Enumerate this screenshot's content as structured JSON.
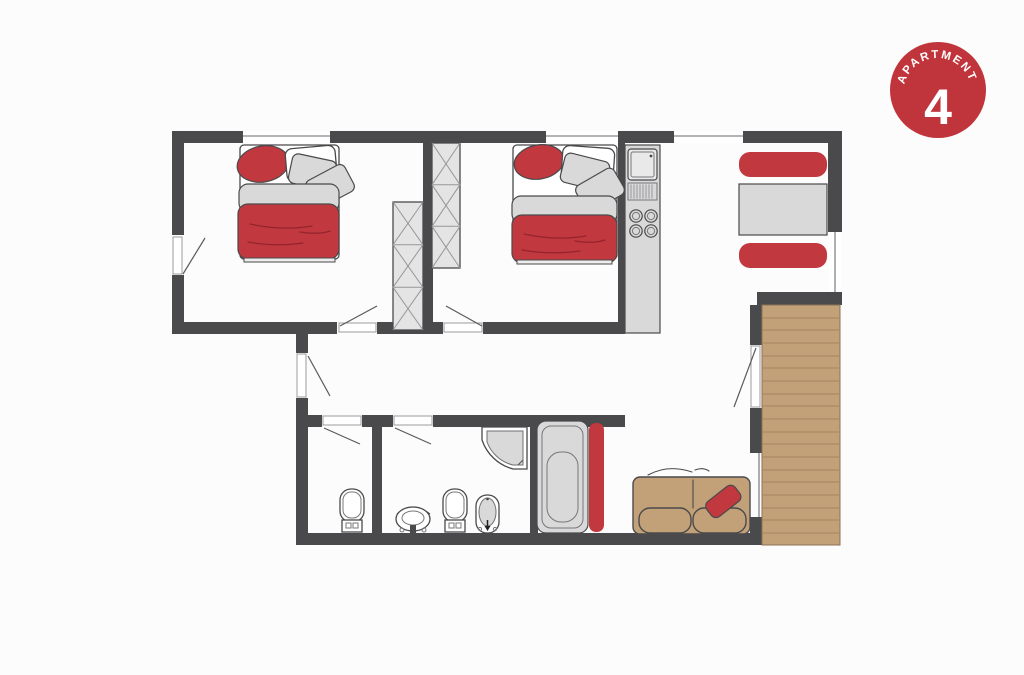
{
  "badge": {
    "label": "APARTMENT",
    "number": "4",
    "bg_color": "#c0353c",
    "text_color": "#ffffff"
  },
  "palette": {
    "wall": "#4a4a4c",
    "accent_red": "#c2383f",
    "furniture_gray": "#d9d9d9",
    "furniture_outline": "#4a4a4c",
    "stairs_wood": "#c2a078",
    "stairs_step_line": "#a5855f",
    "sofa_tan": "#c2a37d",
    "wardrobe_fill": "#e4e4e4",
    "window_line": "#9b9b9e",
    "background": "#fcfcfc"
  },
  "plan_icons": [
    "double-bed-icon",
    "double-bed-icon",
    "wardrobe-crosshatch-icon",
    "wardrobe-crosshatch-icon",
    "kitchen-sink-icon",
    "kitchen-hob-icon",
    "dining-table-icon",
    "bench-seat-icon",
    "bench-seat-icon",
    "staircase-icon",
    "corner-shower-icon",
    "bathtub-icon",
    "toilet-icon",
    "toilet-icon",
    "wash-basin-icon",
    "bidet-icon",
    "sofa-icon",
    "door-swing-icon",
    "window-icon"
  ]
}
